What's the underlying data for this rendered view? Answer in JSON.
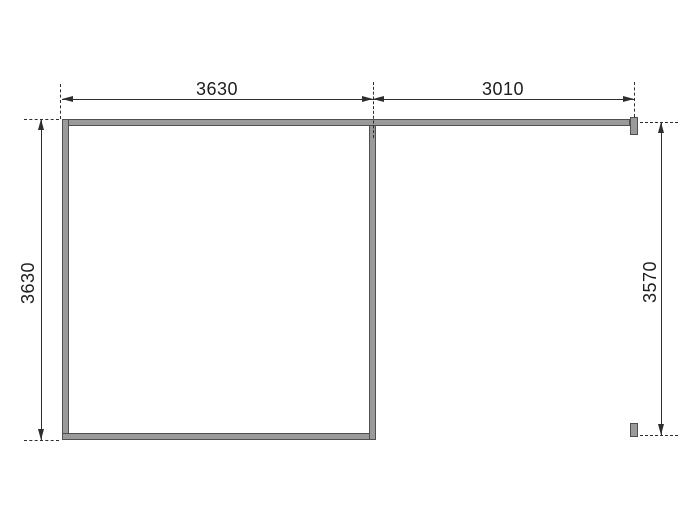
{
  "diagram": {
    "kind": "floor-plan-dimension-drawing",
    "dimension_labels": {
      "top_span_left": "3630",
      "top_span_right": "3010",
      "left_span": "3630",
      "right_span": "3570"
    },
    "colors": {
      "background": "#ffffff",
      "wall_fill": "#9a9a9a",
      "wall_border": "#4f4f4f",
      "dim_line": "#2e2e2e",
      "label_text": "#1d1d1d"
    }
  }
}
